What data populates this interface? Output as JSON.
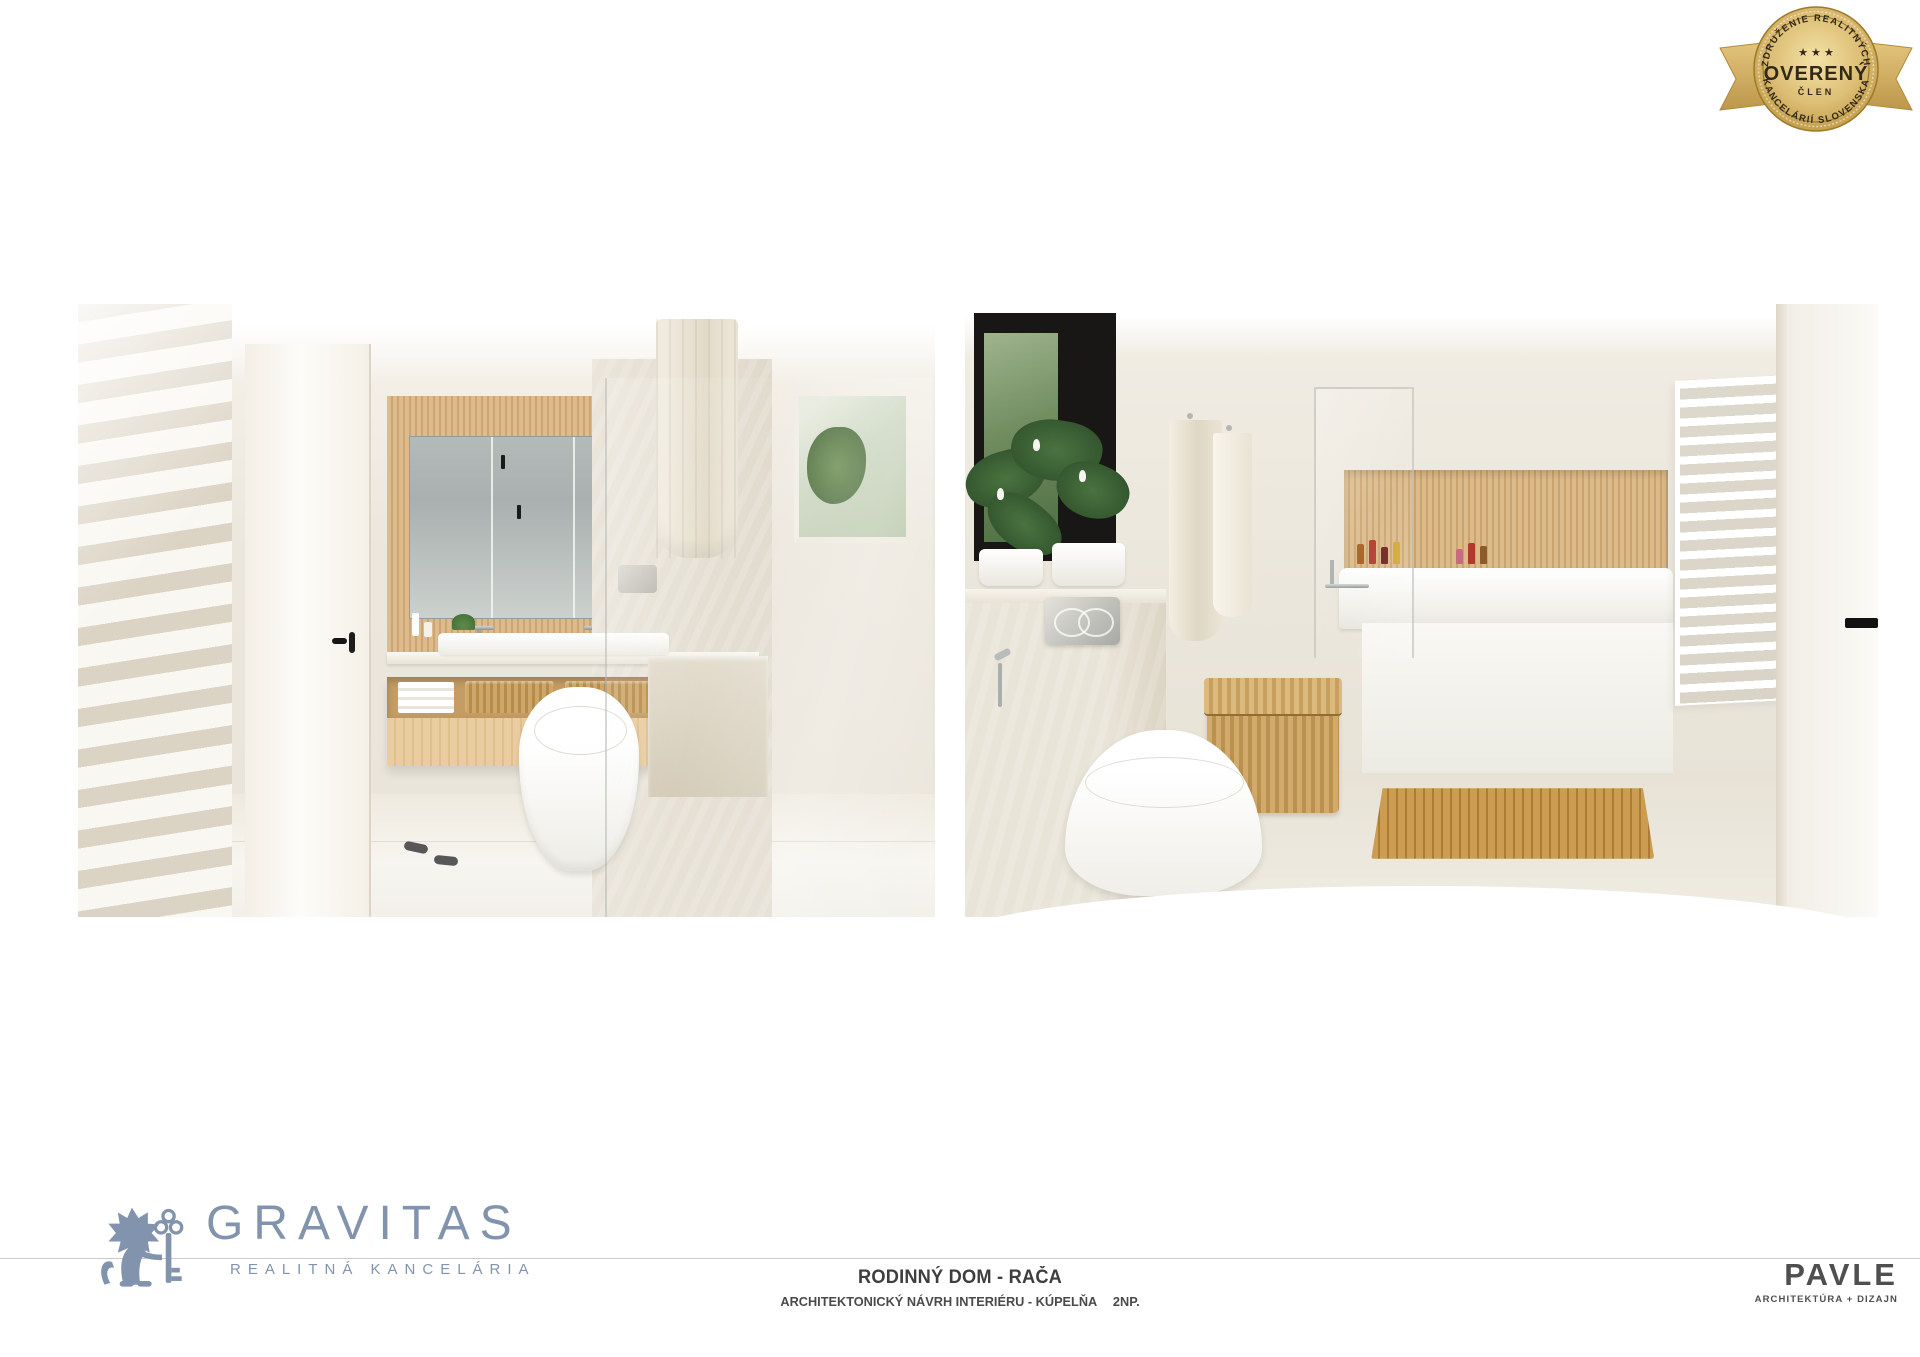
{
  "badge": {
    "arc_top": "ZDRUŽENIE REALITNÝCH",
    "stars": "★ ★ ★",
    "wordmark": "OVERENÝ",
    "member": "ČLEN",
    "arc_bottom": "KANCELÁRIÍ SLOVENSKA"
  },
  "footer": {
    "gravitas": {
      "wordmark": "GRAVITAS",
      "tagline": "REALITNÁ KANCELÁRIA"
    },
    "project": {
      "title": "RODINNÝ DOM - RAČA",
      "subtitle": "ARCHITEKTONICKÝ NÁVRH INTERIÉRU - KÚPELŇA",
      "floor": "2NP."
    },
    "pavle": {
      "wordmark": "PAVLE",
      "tagline": "ARCHITEKTÚRA + DIZAJN"
    }
  },
  "colors": {
    "gravitas_blue": "#8294ad",
    "badge_gold": "#d8b766",
    "badge_gold_dark": "#ab8432",
    "badge_text": "#33291a",
    "title_text": "#3e3e3e",
    "rule_line": "#c6cad1",
    "pavle_gray": "#4f4f4f"
  },
  "toiletries": {
    "colors": [
      "#a85b1e",
      "#b03a2e",
      "#6e1d1d",
      "#d2a52f",
      "#c96a84",
      "#b03a2e",
      "#8c5a2b"
    ]
  }
}
